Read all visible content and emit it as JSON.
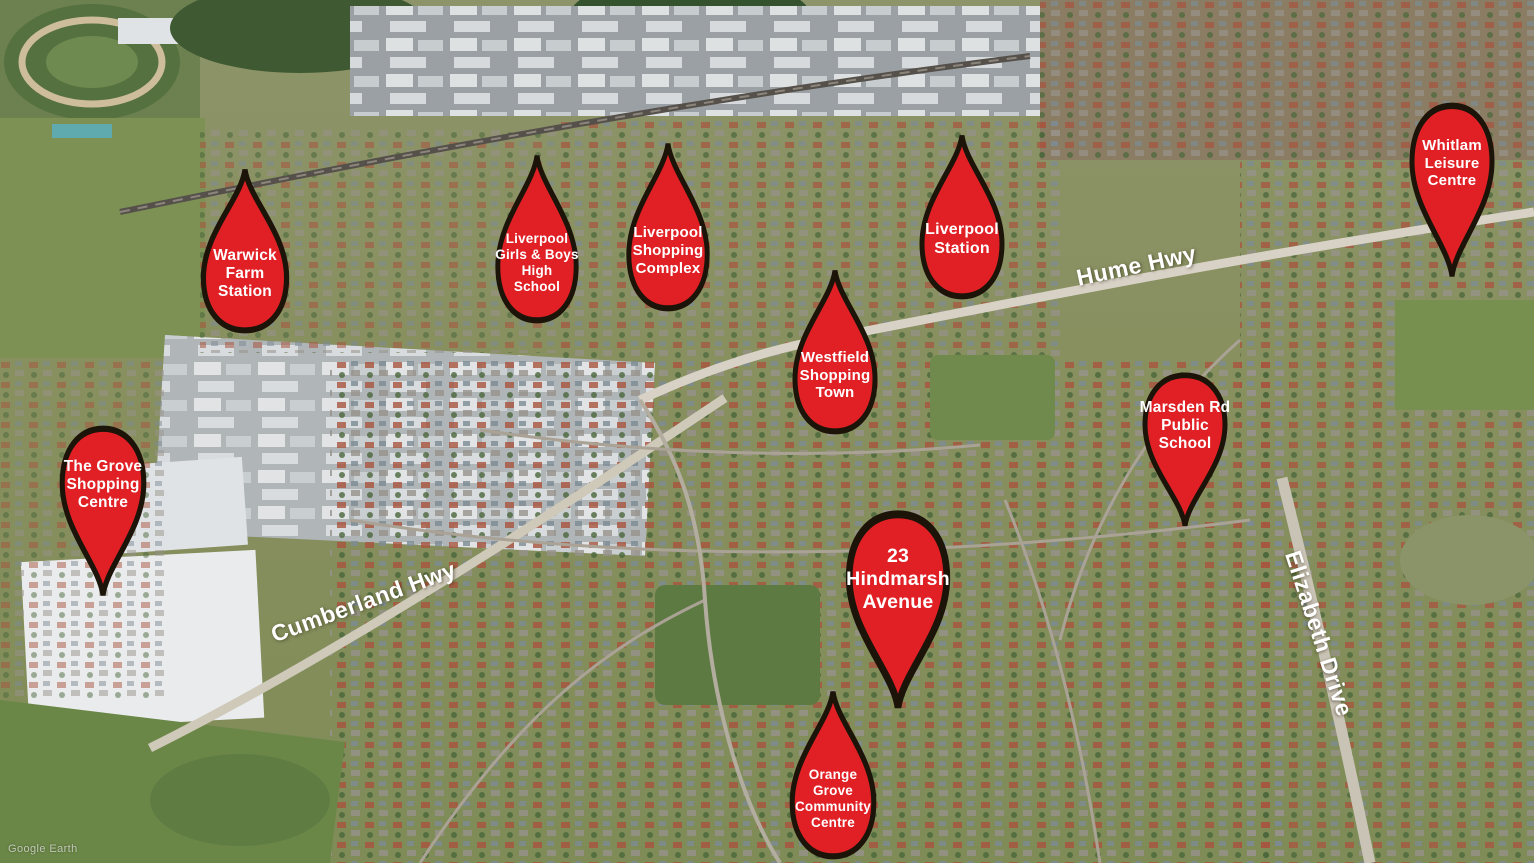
{
  "map": {
    "attribution": "Google Earth",
    "colors": {
      "marker_fill": "#e02025",
      "marker_outline": "#1c1309",
      "marker_text": "#ffffff",
      "road_label_text": "#ffffff"
    },
    "road_labels": [
      {
        "label": "Hume Hwy"
      },
      {
        "label": "Cumberland Hwy"
      },
      {
        "label": "Elizabeth Drive"
      }
    ],
    "markers": [
      {
        "label": "Warwick\nFarm\nStation"
      },
      {
        "label": "Liverpool\nGirls & Boys\nHigh\nSchool"
      },
      {
        "label": "Liverpool\nShopping\nComplex"
      },
      {
        "label": "Liverpool\nStation"
      },
      {
        "label": "Whitlam\nLeisure\nCentre"
      },
      {
        "label": "Westfield\nShopping\nTown"
      },
      {
        "label": "Marsden Rd\nPublic\nSchool"
      },
      {
        "label": "The Grove\nShopping\nCentre"
      },
      {
        "label": "23\nHindmarsh\nAvenue"
      },
      {
        "label": "Orange\nGrove\nCommunity\nCentre"
      }
    ]
  }
}
